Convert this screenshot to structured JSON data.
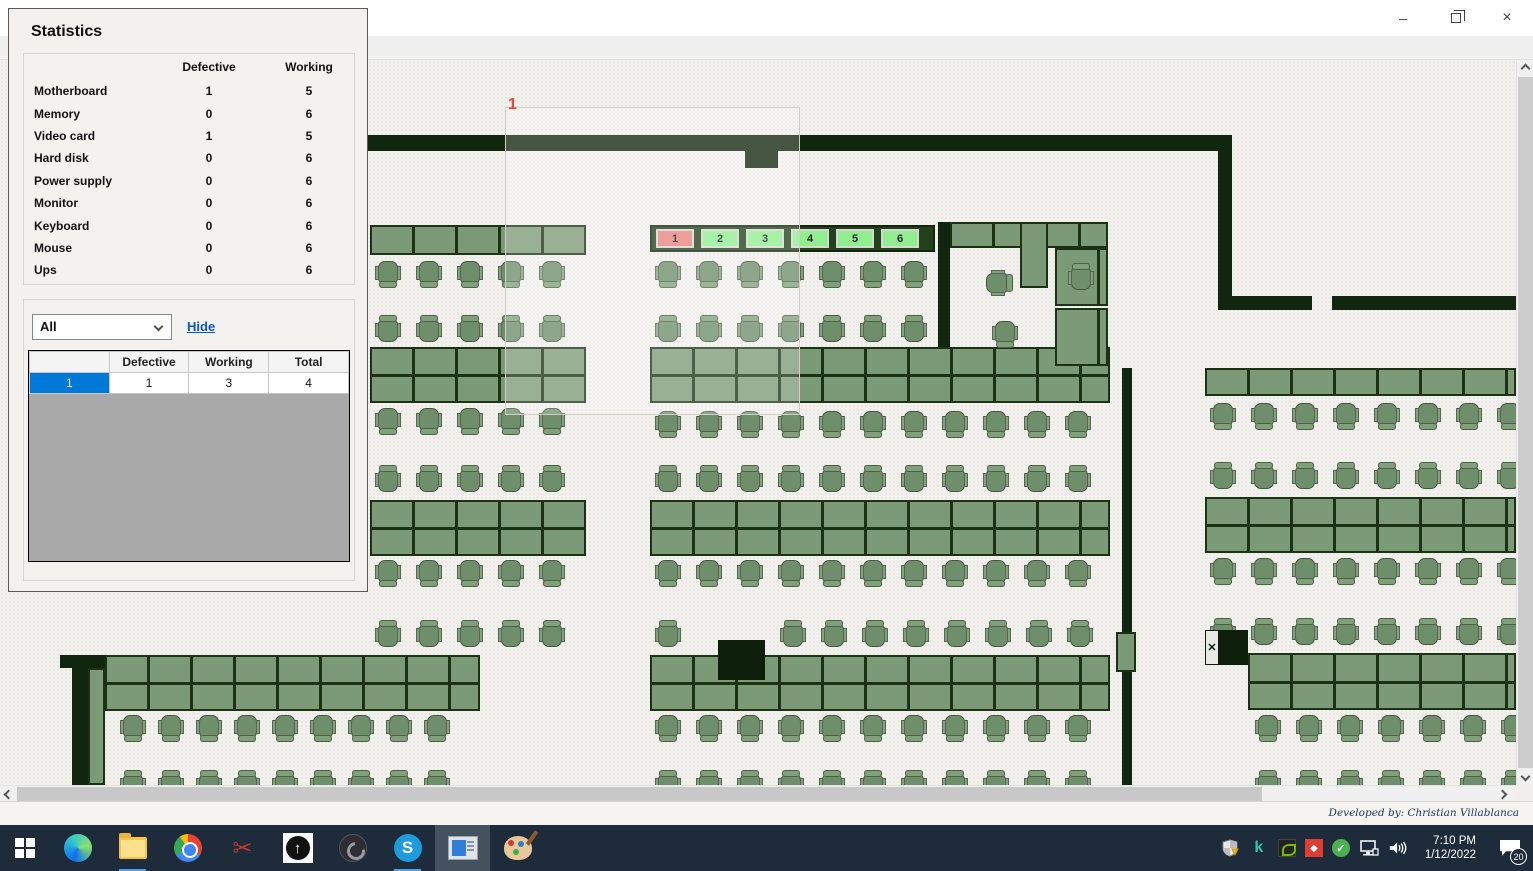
{
  "window": {
    "title": "Monitoring",
    "controls": {
      "minimize": "–",
      "restore": "❐",
      "close": "×"
    }
  },
  "menu": {
    "items": [
      {
        "label": "Import layout"
      },
      {
        "label": "Refresh"
      },
      {
        "label": "Add border"
      },
      {
        "label": "Logs"
      },
      {
        "label": "Tools"
      }
    ]
  },
  "statistics": {
    "title": "Statistics",
    "columns": {
      "defective": "Defective",
      "working": "Working"
    },
    "components": [
      {
        "name": "Motherboard",
        "defective": 1,
        "working": 5
      },
      {
        "name": "Memory",
        "defective": 0,
        "working": 6
      },
      {
        "name": "Video card",
        "defective": 1,
        "working": 5
      },
      {
        "name": "Hard disk",
        "defective": 0,
        "working": 6
      },
      {
        "name": "Power supply",
        "defective": 0,
        "working": 6
      },
      {
        "name": "Monitor",
        "defective": 0,
        "working": 6
      },
      {
        "name": "Keyboard",
        "defective": 0,
        "working": 6
      },
      {
        "name": "Mouse",
        "defective": 0,
        "working": 6
      },
      {
        "name": "Ups",
        "defective": 0,
        "working": 6
      }
    ],
    "filter": {
      "selected": "All",
      "hide_label": "Hide"
    },
    "grid": {
      "columns": [
        "",
        "Defective",
        "Working",
        "Total"
      ],
      "rows": [
        {
          "header": "1",
          "defective": 1,
          "working": 3,
          "total": 4
        }
      ]
    }
  },
  "map": {
    "selection_label": "1",
    "stations": [
      {
        "label": "1",
        "status": "defective"
      },
      {
        "label": "2",
        "status": "working"
      },
      {
        "label": "3",
        "status": "working"
      },
      {
        "label": "4",
        "status": "working"
      },
      {
        "label": "5",
        "status": "working"
      },
      {
        "label": "6",
        "status": "working"
      }
    ],
    "colors": {
      "wall": "#11260e",
      "desk": "#7d9a78",
      "desk_border": "#1b3314",
      "chair": "#6f8f6c",
      "station_working": "#90ee90",
      "station_defective": "#e9837b",
      "selected_row": "#0078d7",
      "floor": "#f1f0ed"
    },
    "floorplan": {
      "walls": [
        {
          "x": 368,
          "y": 75,
          "w": 864,
          "h": 16
        },
        {
          "x": 745,
          "y": 91,
          "w": 33,
          "h": 17
        },
        {
          "x": 1218,
          "y": 75,
          "w": 14,
          "h": 175
        },
        {
          "x": 1232,
          "y": 236,
          "w": 80,
          "h": 14
        },
        {
          "x": 1332,
          "y": 236,
          "w": 201,
          "h": 14
        },
        {
          "x": 938,
          "y": 162,
          "w": 12,
          "h": 156
        },
        {
          "x": 938,
          "y": 306,
          "w": 172,
          "h": 12
        },
        {
          "x": 1122,
          "y": 308,
          "w": 10,
          "h": 417
        },
        {
          "x": 72,
          "y": 595,
          "w": 18,
          "h": 130
        },
        {
          "x": 60,
          "y": 595,
          "w": 65,
          "h": 13
        }
      ],
      "desks": [
        {
          "x": 370,
          "y": 165,
          "w": 216,
          "h": 30,
          "double": false
        },
        {
          "x": 370,
          "y": 287,
          "w": 216,
          "h": 56,
          "double": true
        },
        {
          "x": 370,
          "y": 440,
          "w": 216,
          "h": 56,
          "double": true
        },
        {
          "x": 650,
          "y": 287,
          "w": 460,
          "h": 56,
          "double": true
        },
        {
          "x": 650,
          "y": 440,
          "w": 460,
          "h": 56,
          "double": true
        },
        {
          "x": 650,
          "y": 595,
          "w": 460,
          "h": 56,
          "double": true
        },
        {
          "x": 1205,
          "y": 308,
          "w": 311,
          "h": 28,
          "double": false
        },
        {
          "x": 1205,
          "y": 437,
          "w": 311,
          "h": 56,
          "double": true
        },
        {
          "x": 1248,
          "y": 593,
          "w": 268,
          "h": 57,
          "double": true
        },
        {
          "x": 105,
          "y": 595,
          "w": 375,
          "h": 56,
          "double": true
        },
        {
          "x": 88,
          "y": 608,
          "w": 17,
          "h": 117,
          "double": false
        },
        {
          "x": 950,
          "y": 162,
          "w": 158,
          "h": 26,
          "double": false
        },
        {
          "x": 1020,
          "y": 162,
          "w": 28,
          "h": 66,
          "double": false
        },
        {
          "x": 1055,
          "y": 188,
          "w": 53,
          "h": 58,
          "double": false
        },
        {
          "x": 1055,
          "y": 248,
          "w": 53,
          "h": 58,
          "double": false
        }
      ],
      "station_strip": {
        "x": 650,
        "y": 165,
        "w": 285,
        "h": 27
      },
      "chair_rows": [
        {
          "x": 375,
          "y": 198,
          "n": 5,
          "dx": 41,
          "face": "up"
        },
        {
          "x": 375,
          "y": 255,
          "n": 5,
          "dx": 41,
          "face": "down"
        },
        {
          "x": 375,
          "y": 345,
          "n": 5,
          "dx": 41,
          "face": "up"
        },
        {
          "x": 375,
          "y": 405,
          "n": 5,
          "dx": 41,
          "face": "down"
        },
        {
          "x": 375,
          "y": 497,
          "n": 5,
          "dx": 41,
          "face": "up"
        },
        {
          "x": 375,
          "y": 560,
          "n": 5,
          "dx": 41,
          "face": "down"
        },
        {
          "x": 120,
          "y": 652,
          "n": 9,
          "dx": 38,
          "face": "up"
        },
        {
          "x": 120,
          "y": 710,
          "n": 9,
          "dx": 38,
          "face": "down"
        },
        {
          "x": 655,
          "y": 198,
          "n": 7,
          "dx": 41,
          "face": "up"
        },
        {
          "x": 655,
          "y": 255,
          "n": 7,
          "dx": 41,
          "face": "down"
        },
        {
          "x": 655,
          "y": 348,
          "n": 11,
          "dx": 41,
          "face": "up"
        },
        {
          "x": 655,
          "y": 405,
          "n": 11,
          "dx": 41,
          "face": "down"
        },
        {
          "x": 655,
          "y": 497,
          "n": 11,
          "dx": 41,
          "face": "up"
        },
        {
          "x": 655,
          "y": 560,
          "n": 1,
          "dx": 41,
          "face": "down"
        },
        {
          "x": 780,
          "y": 560,
          "n": 8,
          "dx": 41,
          "face": "down"
        },
        {
          "x": 655,
          "y": 652,
          "n": 11,
          "dx": 41,
          "face": "up"
        },
        {
          "x": 655,
          "y": 710,
          "n": 11,
          "dx": 41,
          "face": "down"
        },
        {
          "x": 1210,
          "y": 340,
          "n": 8,
          "dx": 41,
          "face": "up"
        },
        {
          "x": 1210,
          "y": 402,
          "n": 8,
          "dx": 41,
          "face": "down"
        },
        {
          "x": 1210,
          "y": 495,
          "n": 8,
          "dx": 41,
          "face": "up"
        },
        {
          "x": 1210,
          "y": 558,
          "n": 8,
          "dx": 41,
          "face": "down"
        },
        {
          "x": 1255,
          "y": 652,
          "n": 7,
          "dx": 41,
          "face": "up"
        },
        {
          "x": 1255,
          "y": 710,
          "n": 7,
          "dx": 41,
          "face": "down"
        }
      ],
      "single_chairs": [
        {
          "x": 985,
          "y": 208,
          "face": "right"
        },
        {
          "x": 992,
          "y": 258,
          "face": "up"
        },
        {
          "x": 1068,
          "y": 203,
          "face": "down"
        }
      ],
      "pillars": [
        {
          "x": 718,
          "y": 580,
          "w": 47,
          "h": 40
        }
      ],
      "door_blocks": [
        {
          "x": 1205,
          "y": 570,
          "w": 43,
          "h": 35
        }
      ],
      "wall_doors": [
        {
          "x": 1116,
          "y": 572,
          "w": 20,
          "h": 40
        }
      ],
      "selection": {
        "x": 505,
        "y": 47,
        "w": 295,
        "h": 308,
        "label_x": 508,
        "label_y": 36
      }
    }
  },
  "status_strip": {
    "credit": "Developed by: Christian Villablanca"
  },
  "taskbar": {
    "apps": [
      {
        "name": "edge"
      },
      {
        "name": "file-explorer",
        "running": true
      },
      {
        "name": "chrome"
      },
      {
        "name": "snipping-tool"
      },
      {
        "name": "uploader-app"
      },
      {
        "name": "obs-studio"
      },
      {
        "name": "skype",
        "letter": "S",
        "running": true
      },
      {
        "name": "monitoring-app",
        "active": true
      },
      {
        "name": "paint"
      }
    ],
    "tray": {
      "k_letter": "k",
      "check_glyph": "✓",
      "red_glyph": "◆"
    },
    "clock": {
      "time": "7:10 PM",
      "date": "1/12/2022"
    },
    "notification_badge": "20"
  }
}
